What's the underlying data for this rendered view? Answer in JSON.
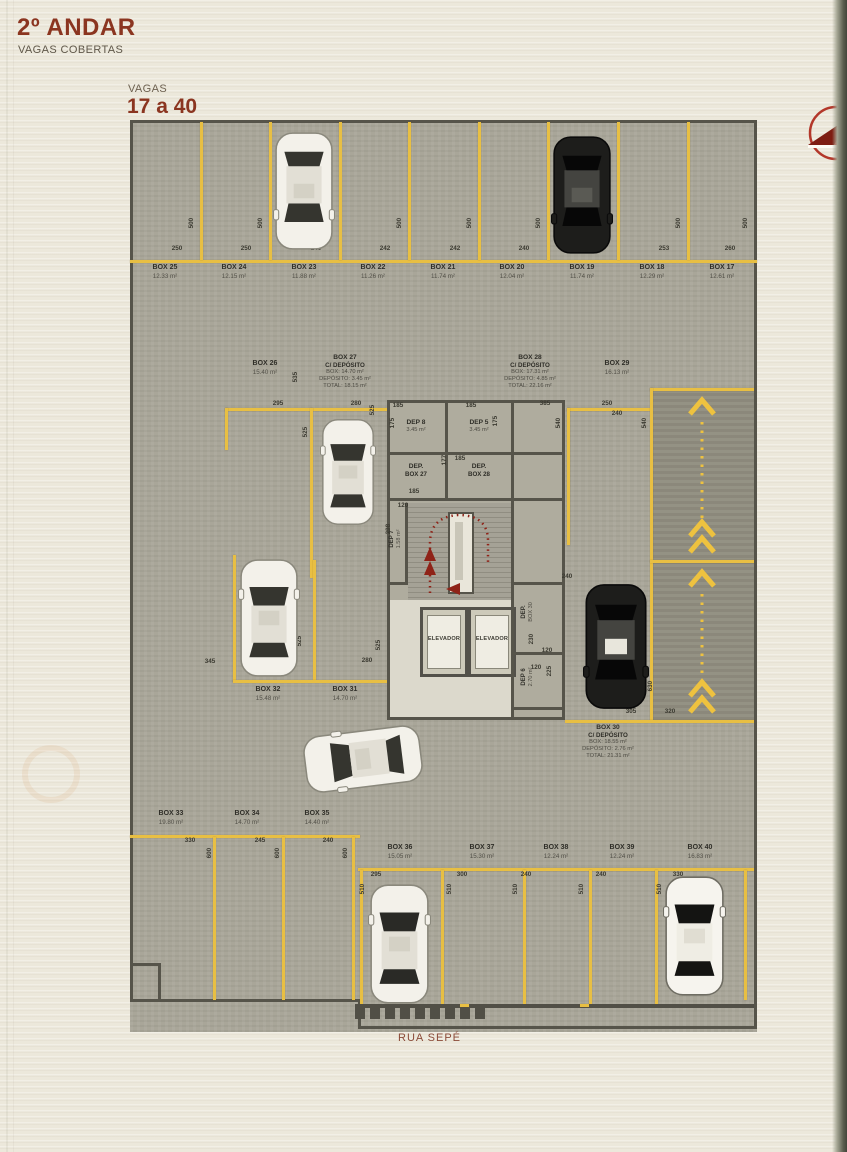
{
  "header": {
    "title": "2º ANDAR",
    "subtitle": "VAGAS COBERTAS",
    "vagas_label": "VAGAS",
    "vagas_range": "17 a 40"
  },
  "street_label": "RUA SEPÉ",
  "core": {
    "elevator": "ELEVADOR",
    "dep8": {
      "label": "DEP 8",
      "area": "3.45 m²"
    },
    "dep5": {
      "label": "DEP 5",
      "area": "3.45 m²"
    },
    "dep_box27": {
      "l1": "DEP.",
      "l2": "BOX 27"
    },
    "dep_box28": {
      "l1": "DEP.",
      "l2": "BOX 28"
    },
    "dep7": {
      "label": "DEP 7",
      "area": "1.58 m²"
    },
    "dep_box30": {
      "l1": "DEP.",
      "l2": "BOX 30"
    },
    "dep6": {
      "label": "DEP 6",
      "area": "2.70 m²"
    }
  },
  "top_row": [
    {
      "label": "BOX 25",
      "area": "12.33 m²",
      "width": "250"
    },
    {
      "label": "BOX 24",
      "area": "12.15 m²",
      "width": "250"
    },
    {
      "label": "BOX 23",
      "area": "11.88 m²",
      "width": "240"
    },
    {
      "label": "BOX 22",
      "area": "11.26 m²",
      "width": "242"
    },
    {
      "label": "BOX 21",
      "area": "11.74 m²",
      "width": "242"
    },
    {
      "label": "BOX 20",
      "area": "12.04 m²",
      "width": "240"
    },
    {
      "label": "BOX 19",
      "area": "11.74 m²",
      "width": "242"
    },
    {
      "label": "BOX 18",
      "area": "12.29 m²",
      "width": "253"
    },
    {
      "label": "BOX 17",
      "area": "12.61 m²",
      "width": "260"
    }
  ],
  "depth_500": "500",
  "depth_600": "600",
  "depth_510": "510",
  "box26": {
    "label": "BOX 26",
    "area": "15.40 m²"
  },
  "box27": {
    "label": "BOX 27",
    "sub": "C/ DEPÓSITO",
    "box": "BOX: 14.70 m²",
    "dep": "DEPÓSITO: 3.45 m²",
    "total": "TOTAL: 18.15 m²"
  },
  "box28": {
    "label": "BOX 28",
    "sub": "C/ DEPÓSITO",
    "box": "BOX: 17.31 m²",
    "dep": "DEPÓSITO: 4.85 m²",
    "total": "TOTAL: 22.16 m²"
  },
  "box29": {
    "label": "BOX 29",
    "area": "16.13 m²"
  },
  "box30": {
    "label": "BOX 30",
    "sub": "C/ DEPÓSITO",
    "box": "BOX: 18.55 m²",
    "dep": "DEPÓSITO: 2.76 m²",
    "total": "TOTAL: 21.31 m²"
  },
  "box31": {
    "label": "BOX 31",
    "area": "14.70 m²"
  },
  "box32": {
    "label": "BOX 32",
    "area": "15.48 m²"
  },
  "bottom_left_row": [
    {
      "label": "BOX 33",
      "area": "19.80 m²",
      "width": "330"
    },
    {
      "label": "BOX 34",
      "area": "14.70 m²",
      "width": "245"
    },
    {
      "label": "BOX 35",
      "area": "14.40 m²",
      "width": "240"
    }
  ],
  "bottom_row": [
    {
      "label": "BOX 36",
      "area": "15.05 m²",
      "width": "295"
    },
    {
      "label": "BOX 37",
      "area": "15.30 m²",
      "width": "300"
    },
    {
      "label": "BOX 38",
      "area": "12.24 m²",
      "width": "240"
    },
    {
      "label": "BOX 39",
      "area": "12.24 m²",
      "width": "240"
    },
    {
      "label": "BOX 40",
      "area": "16.83 m²",
      "width": "330"
    }
  ],
  "dims": [
    "535",
    "295",
    "525",
    "280",
    "525",
    "185",
    "175",
    "185",
    "175",
    "177",
    "185",
    "185",
    "120",
    "298",
    "385",
    "540",
    "250",
    "540",
    "240",
    "240",
    "345",
    "295",
    "525",
    "280",
    "525",
    "230",
    "120",
    "120",
    "225",
    "630",
    "305",
    "320"
  ],
  "colors": {
    "accent_red": "#8b3520",
    "line_yellow": "#e8bf43",
    "plan_gray": "#a9a699",
    "wall_gray": "#56544a"
  }
}
